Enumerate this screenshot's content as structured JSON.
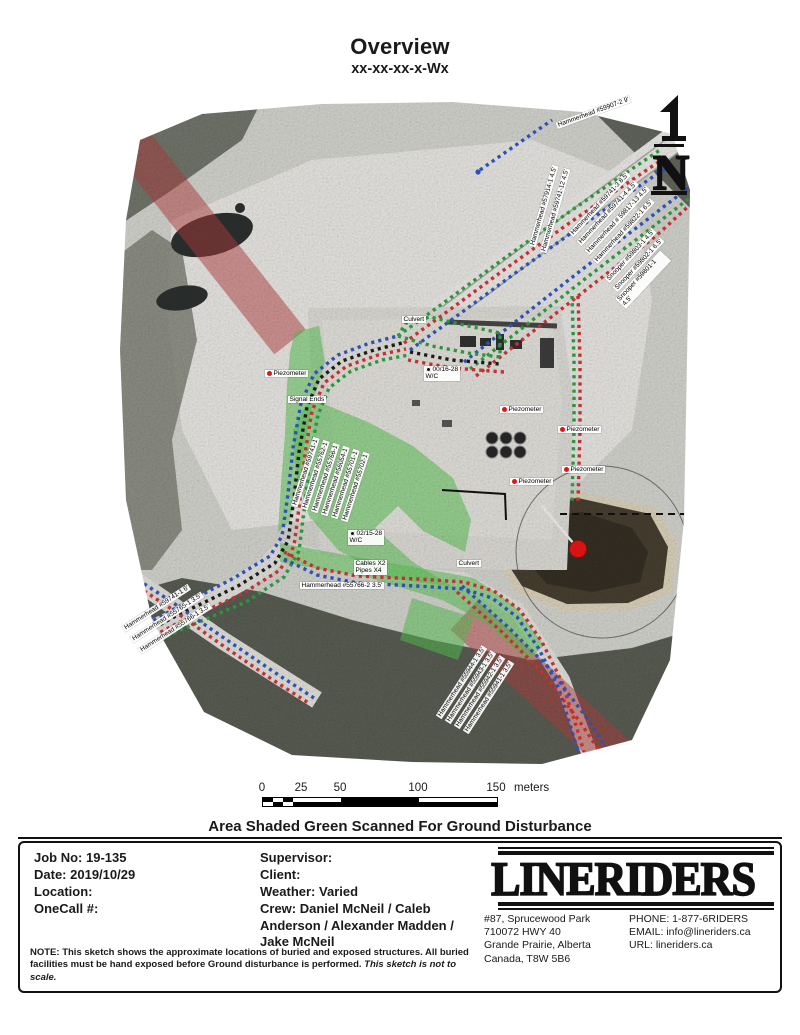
{
  "header": {
    "title": "Overview",
    "subtitle": "xx-xx-xx-x-Wx"
  },
  "north_arrow": {
    "letter": "N"
  },
  "colors": {
    "scan_green": "#58bf52",
    "row_red": "#b23c3c",
    "line_blue": "#2f55c2",
    "line_red": "#cf3333",
    "line_green": "#2f9e42",
    "line_black": "#1d1d1d",
    "marker_red": "#e41414"
  },
  "map": {
    "annotations": [
      {
        "text": "Hammerhead #59907-2   9'",
        "x": 446,
        "y": 22,
        "rot": -20
      },
      {
        "text": "Hammerhead #57914-1   4.5'",
        "x": 424,
        "y": 140,
        "rot": -74
      },
      {
        "text": "Hammerhead #59741-12   4.5'",
        "x": 435,
        "y": 146,
        "rot": -74
      },
      {
        "text": "Hammerhead #59741-3   8.5'",
        "x": 462,
        "y": 130,
        "rot": -47
      },
      {
        "text": "Hammerhead #59741-4   4.5'",
        "x": 470,
        "y": 139,
        "rot": -47
      },
      {
        "text": "Hammerhead # 59817-13   4.5'",
        "x": 478,
        "y": 148,
        "rot": -47
      },
      {
        "text": "Hammerhead #59822-1   6.5'",
        "x": 486,
        "y": 157,
        "rot": -47
      },
      {
        "text": "Snooper #59803-1   4.5'",
        "x": 498,
        "y": 176,
        "rot": -47
      },
      {
        "text": "Snooper #59802-1   6.5'",
        "x": 506,
        "y": 185,
        "rot": -47
      },
      {
        "text": "Snooper #59801-1   4.5'",
        "x": 514,
        "y": 194,
        "rot": -47
      },
      {
        "text": "Hammerhead #59741-1",
        "x": 186,
        "y": 400,
        "rot": -72
      },
      {
        "text": "Hammerhead #55762-1",
        "x": 196,
        "y": 403,
        "rot": -72
      },
      {
        "text": "Hammerhead #55766-1",
        "x": 206,
        "y": 406,
        "rot": -72
      },
      {
        "text": "Hammerhead #56054-1",
        "x": 216,
        "y": 409,
        "rot": -72
      },
      {
        "text": "Hammerhead #55701-1",
        "x": 226,
        "y": 412,
        "rot": -72
      },
      {
        "text": "Hammerhead #55702-1",
        "x": 236,
        "y": 415,
        "rot": -72
      },
      {
        "text": "Hammerhead #59741-1   6'",
        "x": 14,
        "y": 525,
        "rot": -33
      },
      {
        "text": "Hammerhead #55765-1   3.5'",
        "x": 22,
        "y": 536,
        "rot": -33
      },
      {
        "text": "Hammerhead #55766-1   3.5'",
        "x": 30,
        "y": 547,
        "rot": -33
      },
      {
        "text": "Hammerhead #55944-1   3.5'",
        "x": 330,
        "y": 612,
        "rot": -57
      },
      {
        "text": "Hammerhead #55943-1   3.5'",
        "x": 339,
        "y": 617,
        "rot": -57
      },
      {
        "text": "Hammerhead #55942-1   3.5'",
        "x": 348,
        "y": 622,
        "rot": -57
      },
      {
        "text": "Hammerhead #55941-1   3.5'",
        "x": 357,
        "y": 627,
        "rot": -57
      },
      {
        "text": "Hammerhead #55766-2   3.5'",
        "x": 188,
        "y": 482,
        "rot": 0
      },
      {
        "text": "Piezometer",
        "x": 153,
        "y": 270,
        "rot": 0,
        "marker": "dot"
      },
      {
        "text": "Piezometer",
        "x": 388,
        "y": 306,
        "rot": 0,
        "marker": "dot"
      },
      {
        "text": "Piezometer",
        "x": 446,
        "y": 326,
        "rot": 0,
        "marker": "dot"
      },
      {
        "text": "Piezometer",
        "x": 450,
        "y": 366,
        "rot": 0,
        "marker": "dot"
      },
      {
        "text": "Piezometer",
        "x": 398,
        "y": 378,
        "rot": 0,
        "marker": "dot"
      },
      {
        "text": "Signal Ends",
        "x": 176,
        "y": 296,
        "rot": 0
      },
      {
        "text": "00/16-28\nW/C",
        "x": 312,
        "y": 266,
        "rot": 0,
        "marker": "well"
      },
      {
        "text": "02/15-28\nW/C",
        "x": 236,
        "y": 430,
        "rot": 0,
        "marker": "well"
      },
      {
        "text": "Cables X2\nPipes X4",
        "x": 242,
        "y": 460,
        "rot": 0
      },
      {
        "text": "Culvert",
        "x": 290,
        "y": 216,
        "rot": 0
      },
      {
        "text": "Culvert",
        "x": 345,
        "y": 460,
        "rot": 0
      }
    ]
  },
  "scale_bar": {
    "ticks": [
      {
        "label": "0",
        "pos": 0
      },
      {
        "label": "25",
        "pos": 39
      },
      {
        "label": "50",
        "pos": 78
      },
      {
        "label": "100",
        "pos": 156
      },
      {
        "label": "150",
        "pos": 234
      }
    ],
    "unit": "meters"
  },
  "banner": {
    "text": "Area Shaded Green Scanned For Ground Disturbance"
  },
  "footer": {
    "job": {
      "rows": [
        {
          "label": "Job No:",
          "value": "19-135"
        },
        {
          "label": "Date:",
          "value": "2019/10/29"
        },
        {
          "label": "Location:",
          "value": ""
        },
        {
          "label": "OneCall #:",
          "value": ""
        }
      ]
    },
    "details": {
      "rows": [
        {
          "label": "Supervisor:",
          "value": ""
        },
        {
          "label": "Client:",
          "value": ""
        },
        {
          "label": "Weather:",
          "value": "Varied"
        },
        {
          "label": "Crew:",
          "value": "Daniel McNeil / Caleb Anderson / Alexander Madden / Jake McNeil"
        }
      ]
    },
    "brand": {
      "logo": "LINERIDERS",
      "address": "#87, Sprucewood Park\n710072 HWY 40\nGrande Prairie, Alberta\nCanada, T8W 5B6",
      "contact": "PHONE: 1-877-6RIDERS\nEMAIL: info@lineriders.ca\nURL: lineriders.ca"
    },
    "note": {
      "prefix": "NOTE:",
      "body": " This sketch shows the approximate locations of buried and exposed structures. All buried facilities must be hand exposed before Ground disturbance is performed. ",
      "italic": "This sketch is not to scale."
    }
  }
}
